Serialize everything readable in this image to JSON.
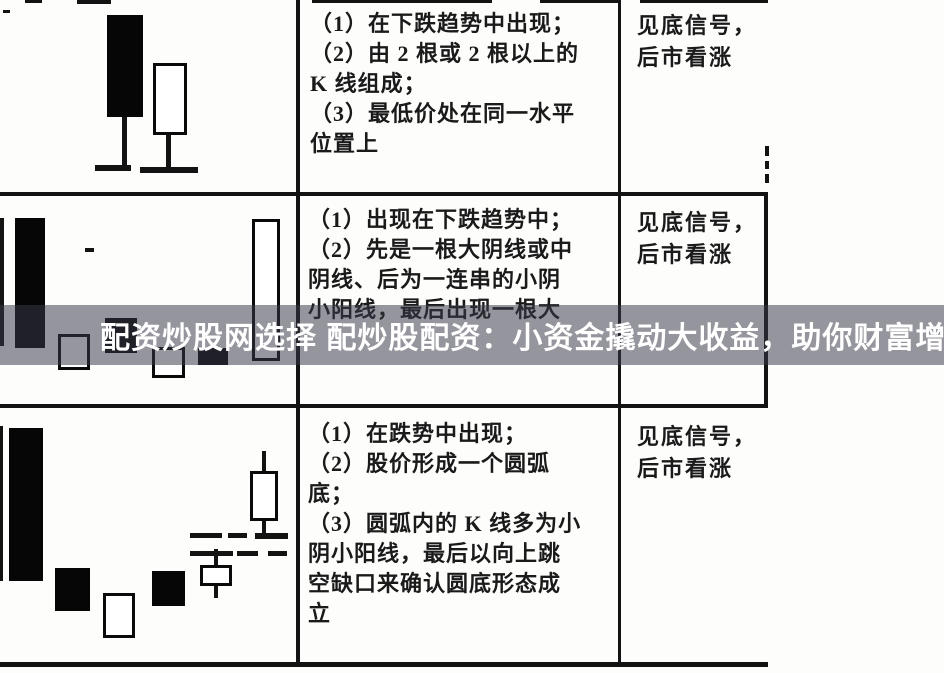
{
  "page": {
    "width": 944,
    "height": 673,
    "background": "#fdfdfc"
  },
  "overlay": {
    "text": "配资炒股网选择 配炒股配资：小资金撬动大收益，助你财富增值",
    "bg": "rgba(56,56,72,0.53)",
    "text_color": "#ffffff"
  },
  "table": {
    "ink_color": "#131313",
    "text_color": "#1a1a1a",
    "h_lines": [
      [
        3,
        10,
        7,
        3
      ],
      [
        25,
        0,
        17,
        3
      ],
      [
        77,
        0,
        34,
        4
      ],
      [
        312,
        0,
        180,
        3
      ],
      [
        540,
        0,
        78,
        3
      ],
      [
        640,
        0,
        128,
        3
      ],
      [
        0,
        192,
        768,
        4
      ],
      [
        0,
        404,
        768,
        4
      ],
      [
        0,
        662,
        768,
        5
      ]
    ],
    "v_lines": [
      [
        296,
        0,
        4,
        666
      ],
      [
        618,
        0,
        3,
        666
      ],
      [
        765,
        146,
        4,
        10
      ],
      [
        765,
        161,
        4,
        8
      ],
      [
        765,
        174,
        4,
        9
      ],
      [
        764,
        193,
        4,
        214
      ],
      [
        0,
        218,
        4,
        128
      ],
      [
        0,
        426,
        3,
        155
      ]
    ],
    "rows": [
      {
        "desc": {
          "x": 310,
          "y": 9,
          "lines": [
            "（1）在下跌趋势中出现；",
            "（2）由 2 根或 2 根以上的",
            "K 线组成；",
            "（3）最低价处在同一水平",
            "位置上"
          ]
        },
        "signal": {
          "x": 637,
          "y": 10,
          "lines": [
            "见底信号，",
            "后市看涨"
          ]
        },
        "shapes": [
          {
            "t": "black",
            "r": [
              107,
              15,
              36,
              102
            ]
          },
          {
            "t": "line",
            "r": [
              122,
              117,
              5,
              50
            ]
          },
          {
            "t": "line",
            "r": [
              95,
              165,
              36,
              6
            ]
          },
          {
            "t": "white",
            "r": [
              153,
              63,
              34,
              72
            ]
          },
          {
            "t": "line",
            "r": [
              166,
              135,
              5,
              33
            ]
          },
          {
            "t": "line",
            "r": [
              140,
              167,
              58,
              6
            ]
          }
        ]
      },
      {
        "desc": {
          "x": 308,
          "y": 205,
          "lines": [
            "（1）出现在下跌趋势中；",
            "（2）先是一根大阴线或中",
            "阴线、后为一连串的小阴",
            "小阳线，最后出现一根大"
          ]
        },
        "signal": {
          "x": 637,
          "y": 207,
          "lines": [
            "见底信号，",
            "后市看涨"
          ]
        },
        "shapes": [
          {
            "t": "black",
            "r": [
              15,
              218,
              30,
              130
            ]
          },
          {
            "t": "line",
            "r": [
              85,
              248,
              9,
              4
            ]
          },
          {
            "t": "white",
            "r": [
              58,
              334,
              32,
              36
            ]
          },
          {
            "t": "black",
            "r": [
              105,
              318,
              32,
              35
            ]
          },
          {
            "t": "white",
            "r": [
              152,
              347,
              33,
              31
            ]
          },
          {
            "t": "black",
            "r": [
              198,
              348,
              30,
              17
            ]
          },
          {
            "t": "white",
            "r": [
              252,
              219,
              28,
              142
            ]
          }
        ]
      },
      {
        "desc": {
          "x": 308,
          "y": 419,
          "lines": [
            "（1）在跌势中出现；",
            "（2）股价形成一个圆弧",
            "底；",
            "（3）圆弧内的 K 线多为小",
            "阴小阳线，最后以向上跳",
            "空缺口来确认圆底形态成",
            "立"
          ]
        },
        "signal": {
          "x": 637,
          "y": 421,
          "lines": [
            "见底信号，",
            "后市看涨"
          ]
        },
        "shapes": [
          {
            "t": "black",
            "r": [
              9,
              428,
              34,
              153
            ]
          },
          {
            "t": "black",
            "r": [
              55,
              568,
              35,
              43
            ]
          },
          {
            "t": "white",
            "r": [
              103,
              593,
              32,
              45
            ]
          },
          {
            "t": "black",
            "r": [
              152,
              571,
              33,
              35
            ]
          },
          {
            "t": "white",
            "r": [
              200,
              565,
              32,
              21
            ]
          },
          {
            "t": "line",
            "r": [
              214,
              549,
              4,
              16
            ]
          },
          {
            "t": "line",
            "r": [
              214,
              586,
              4,
              12
            ]
          },
          {
            "t": "line",
            "r": [
              190,
              533,
              32,
              5
            ]
          },
          {
            "t": "line",
            "r": [
              228,
              533,
              19,
              5
            ]
          },
          {
            "t": "line",
            "r": [
              255,
              533,
              33,
              6
            ]
          },
          {
            "t": "line",
            "r": [
              190,
              551,
              43,
              5
            ]
          },
          {
            "t": "line",
            "r": [
              237,
              551,
              21,
              5
            ]
          },
          {
            "t": "line",
            "r": [
              268,
              551,
              19,
              5
            ]
          },
          {
            "t": "white",
            "r": [
              250,
              471,
              28,
              50
            ]
          },
          {
            "t": "line",
            "r": [
              262,
              451,
              4,
              20
            ]
          },
          {
            "t": "line",
            "r": [
              262,
              521,
              4,
              12
            ]
          }
        ]
      }
    ]
  }
}
